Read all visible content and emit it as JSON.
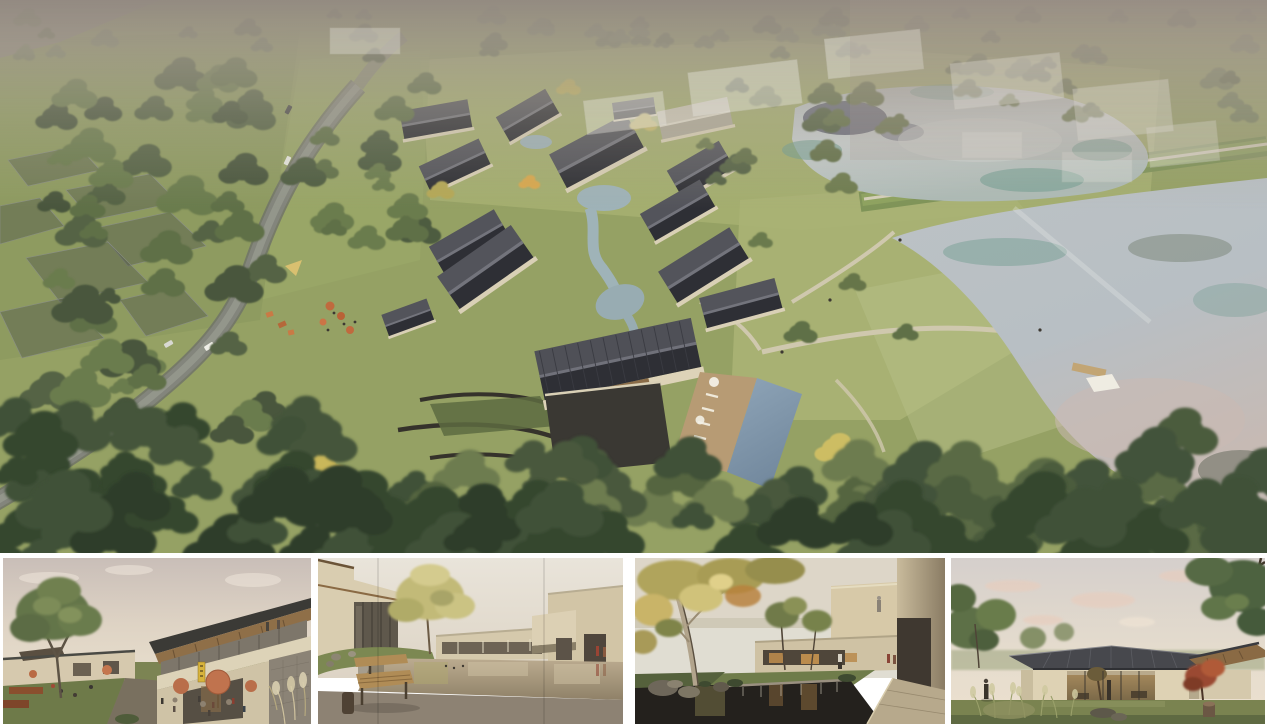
{
  "board": {
    "type": "architectural rendering presentation board",
    "background_color": "#ffffff",
    "layout": "one large aerial masterplan render on top, four eye-level renders in a strip below"
  },
  "aerial_render": {
    "alt": "Aerial view of a village-style resort: a curving gray road through dense woodland on the left with a few cars, translucent future-plot outlines in the left meadow, a cluster of houses with dark pitched roofs and cream walls arranged around a winding stream, a central hall with a large ribbed charcoal roof and stone courtyard, a rectangular swimming pool with timber sun deck and white umbrellas, lawns crossed by light paths leading to two large mirror-like ponds separated by a grass dam, hazy translucent context massing at the top, and a dense band of tree canopy along the bottom edge",
    "features": [
      "curving access road",
      "cars on road",
      "translucent plot overlays",
      "village houses with dark gable roofs",
      "winding stream and ponds",
      "central hall with ribbed roof",
      "stone courtyard with boulders",
      "swimming pool and timber deck",
      "white pool umbrellas",
      "lawn paths",
      "grass dam with footpath",
      "upper pond",
      "lower pond with pink sky reflection",
      "timber jetty and white canopy tent",
      "cafe terrace with orange umbrellas",
      "playground",
      "autumn-yellow trees",
      "hazy context buildings"
    ],
    "palette": {
      "haze_top": "#948b83",
      "grass": "#95a164",
      "sunlit_lawn": "#b5bd85",
      "forest_dark": "#49573c",
      "forest_mid": "#5f7047",
      "canopy_bottom": "#36462f",
      "autumn_yellow": "#c9b75a",
      "road_gray": "#83857c",
      "roof_dark": "#2e2f35",
      "roof_lit": "#53545b",
      "wall_cream": "#ddd3b8",
      "water_silver": "#c3c9cc",
      "water_teal": "#6f9c8f",
      "water_dark_reflection": "#4e4f63",
      "water_pink_sheen": "#cbb9b2",
      "pool_blue": "#7e97ab",
      "deck_tan": "#b79b74",
      "path_beige": "#cfc8ae"
    }
  },
  "thumbnails": [
    {
      "id": "street-view",
      "alt": "Street-level view of a two-story building with an up-sloping roof and exposed wood soffit, glazed upper gallery with visitors, a cafe terrace with salmon umbrellas and seated guests, a yellow storefront sign, rubble stone wall and plume grasses at right, and a lawn with a large tree at left under a soft pink-gray sky",
      "accents": {
        "umbrella": "#c0734e",
        "sign_yellow": "#d8b43c",
        "soffit_wood": "#8f6f48"
      }
    },
    {
      "id": "pond-courtyard",
      "alt": "Courtyard with a mirror-still pond reflecting cream buildings, a glazed two-story house at left on a grassy mound with rocks, a tall yellow-green tree, two figures in red and rust coats walking at right, and a slatted wood bench with a carved stool on a smooth concrete deck in the foreground",
      "accents": {
        "bench_wood": "#b08c56",
        "pond_tan": "#b3a488",
        "figure_red": "#9a4434"
      }
    },
    {
      "id": "waterfall-courtyard",
      "alt": "Shaded garden court with a large plane tree with dappled autumn foliage at left, a dark koi pond with a stone weir and small waterfall in the foreground, mossy rocks, a warm-lit glass pavilion beyond the lawn, and a cream cantilevered balcony volume at right with a person standing on its edge",
      "accents": {
        "foliage_autumn": "#b0a45c",
        "pond_dark": "#24211d",
        "stone_walk": "#b7a98c"
      }
    },
    {
      "id": "pavilion-lawn",
      "alt": "Single-story pavilion with a dark standing-seam hipped roof and fully glazed warm-lit front wall seen across a lawn with feathery ornamental grasses, rocks and a stump, framed by large green trees on both sides, a small red maple beside the pavilion, and a pale pink evening sky with soft clouds",
      "accents": {
        "roof": "#47484d",
        "interior_glow": "#9a7c50",
        "maple_red": "#9a4a30"
      }
    }
  ]
}
